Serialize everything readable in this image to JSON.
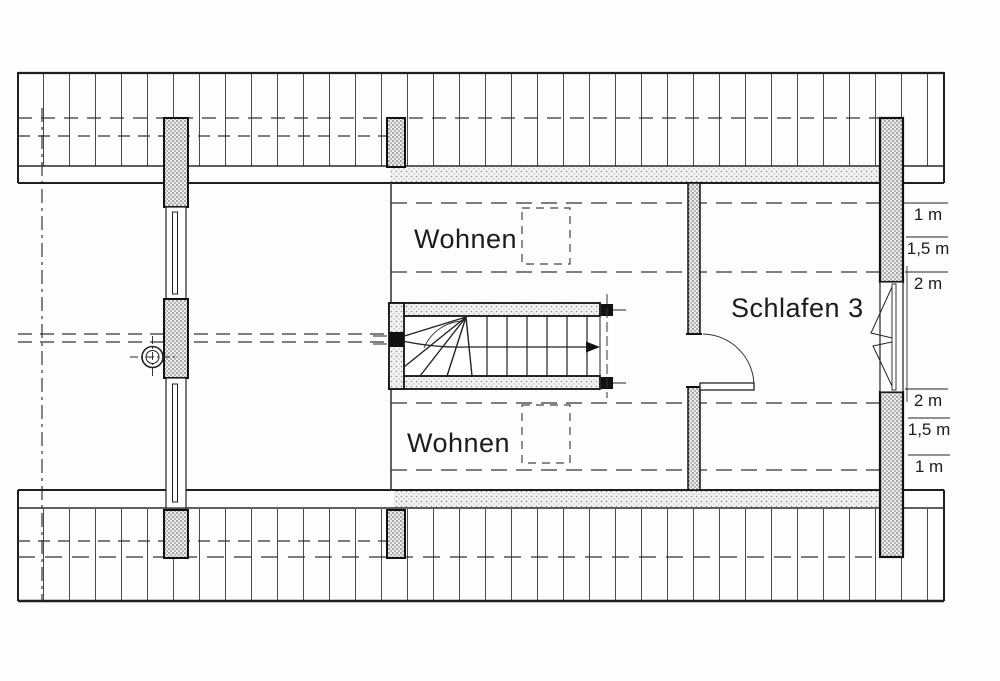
{
  "rooms": [
    {
      "label": "Wohnen"
    },
    {
      "label": "Wohnen"
    },
    {
      "label": "Schlafen 3"
    }
  ],
  "height_markers": {
    "upper": [
      {
        "label": "1 m"
      },
      {
        "label": "1,5 m"
      },
      {
        "label": "2 m"
      }
    ],
    "lower": [
      {
        "label": "2 m"
      },
      {
        "label": "1,5 m"
      },
      {
        "label": "1 m"
      }
    ]
  },
  "colors": {
    "line": "#1f1f1f",
    "paper": "#fdfdfc",
    "hatch_dark": "#7a7a7a",
    "hatch_light": "#9a9a9a"
  }
}
